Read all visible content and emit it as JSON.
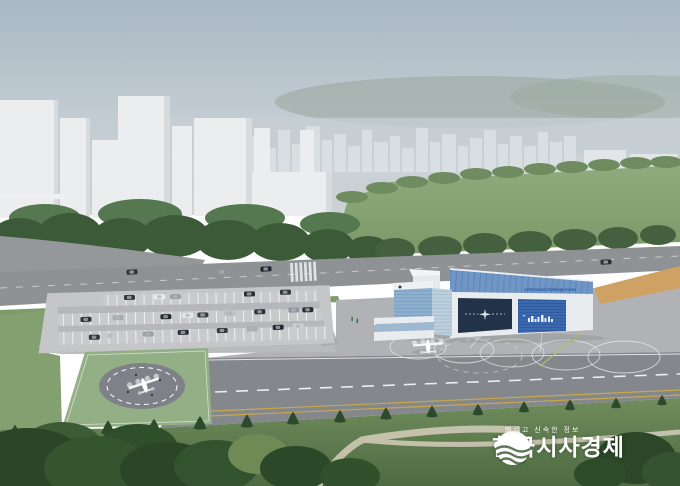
{
  "building": {
    "sign": "UAM Grand Challenge Korea"
  },
  "watermark": {
    "slogan": "빠르고 신속한 정보",
    "name": "한국시사경제"
  },
  "colors": {
    "hangar_roof_blue": "#6f96c5",
    "hangar_door_navy": "#223349",
    "hangar_door_blue": "#3a69b0",
    "vertiport_green": "#93af85",
    "field_green": "#85a274",
    "runway_gray": "#84878b",
    "watermark_white": "#ffffff"
  }
}
